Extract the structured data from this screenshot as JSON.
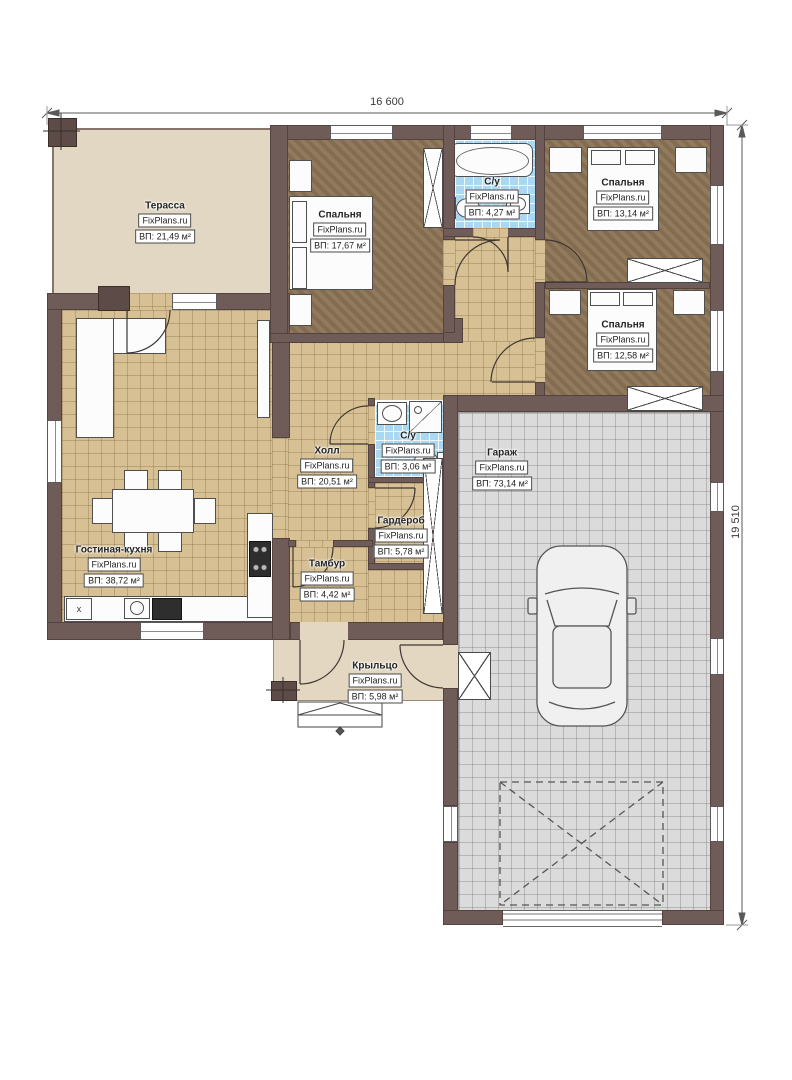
{
  "watermark": "FixPlans.ru",
  "dimensions": {
    "top": "16 600",
    "right": "19 510"
  },
  "rooms": [
    {
      "name": "Терасса",
      "area": "ВП: 21,49 м²"
    },
    {
      "name": "Спальня",
      "area": "ВП: 17,67 м²"
    },
    {
      "name": "С/у",
      "area": "ВП: 4,27 м²"
    },
    {
      "name": "Спальня",
      "area": "ВП: 13,14 м²"
    },
    {
      "name": "Спальня",
      "area": "ВП: 12,58 м²"
    },
    {
      "name": "Холл",
      "area": "ВП: 20,51 м²"
    },
    {
      "name": "С/у",
      "area": "ВП: 3,06 м²"
    },
    {
      "name": "Гараж",
      "area": "ВП: 73,14 м²"
    },
    {
      "name": "Гардероб",
      "area": "ВП: 5,78 м²"
    },
    {
      "name": "Гостиная-кухня",
      "area": "ВП: 38,72 м²"
    },
    {
      "name": "Тамбур",
      "area": "ВП: 4,42 м²"
    },
    {
      "name": "Крыльцо",
      "area": "ВП: 5,98 м²"
    }
  ],
  "marks": {
    "washer": "x"
  },
  "colors": {
    "wall": "#6f5b58",
    "floor_tile": "#d6c094",
    "bedroom_floor": "#8b7355",
    "bath_tile": "#a9d8f3",
    "garage_floor": "#dbdbdb",
    "terrace_floor": "#e2d7c3",
    "porch_floor": "#e3d7c1"
  }
}
